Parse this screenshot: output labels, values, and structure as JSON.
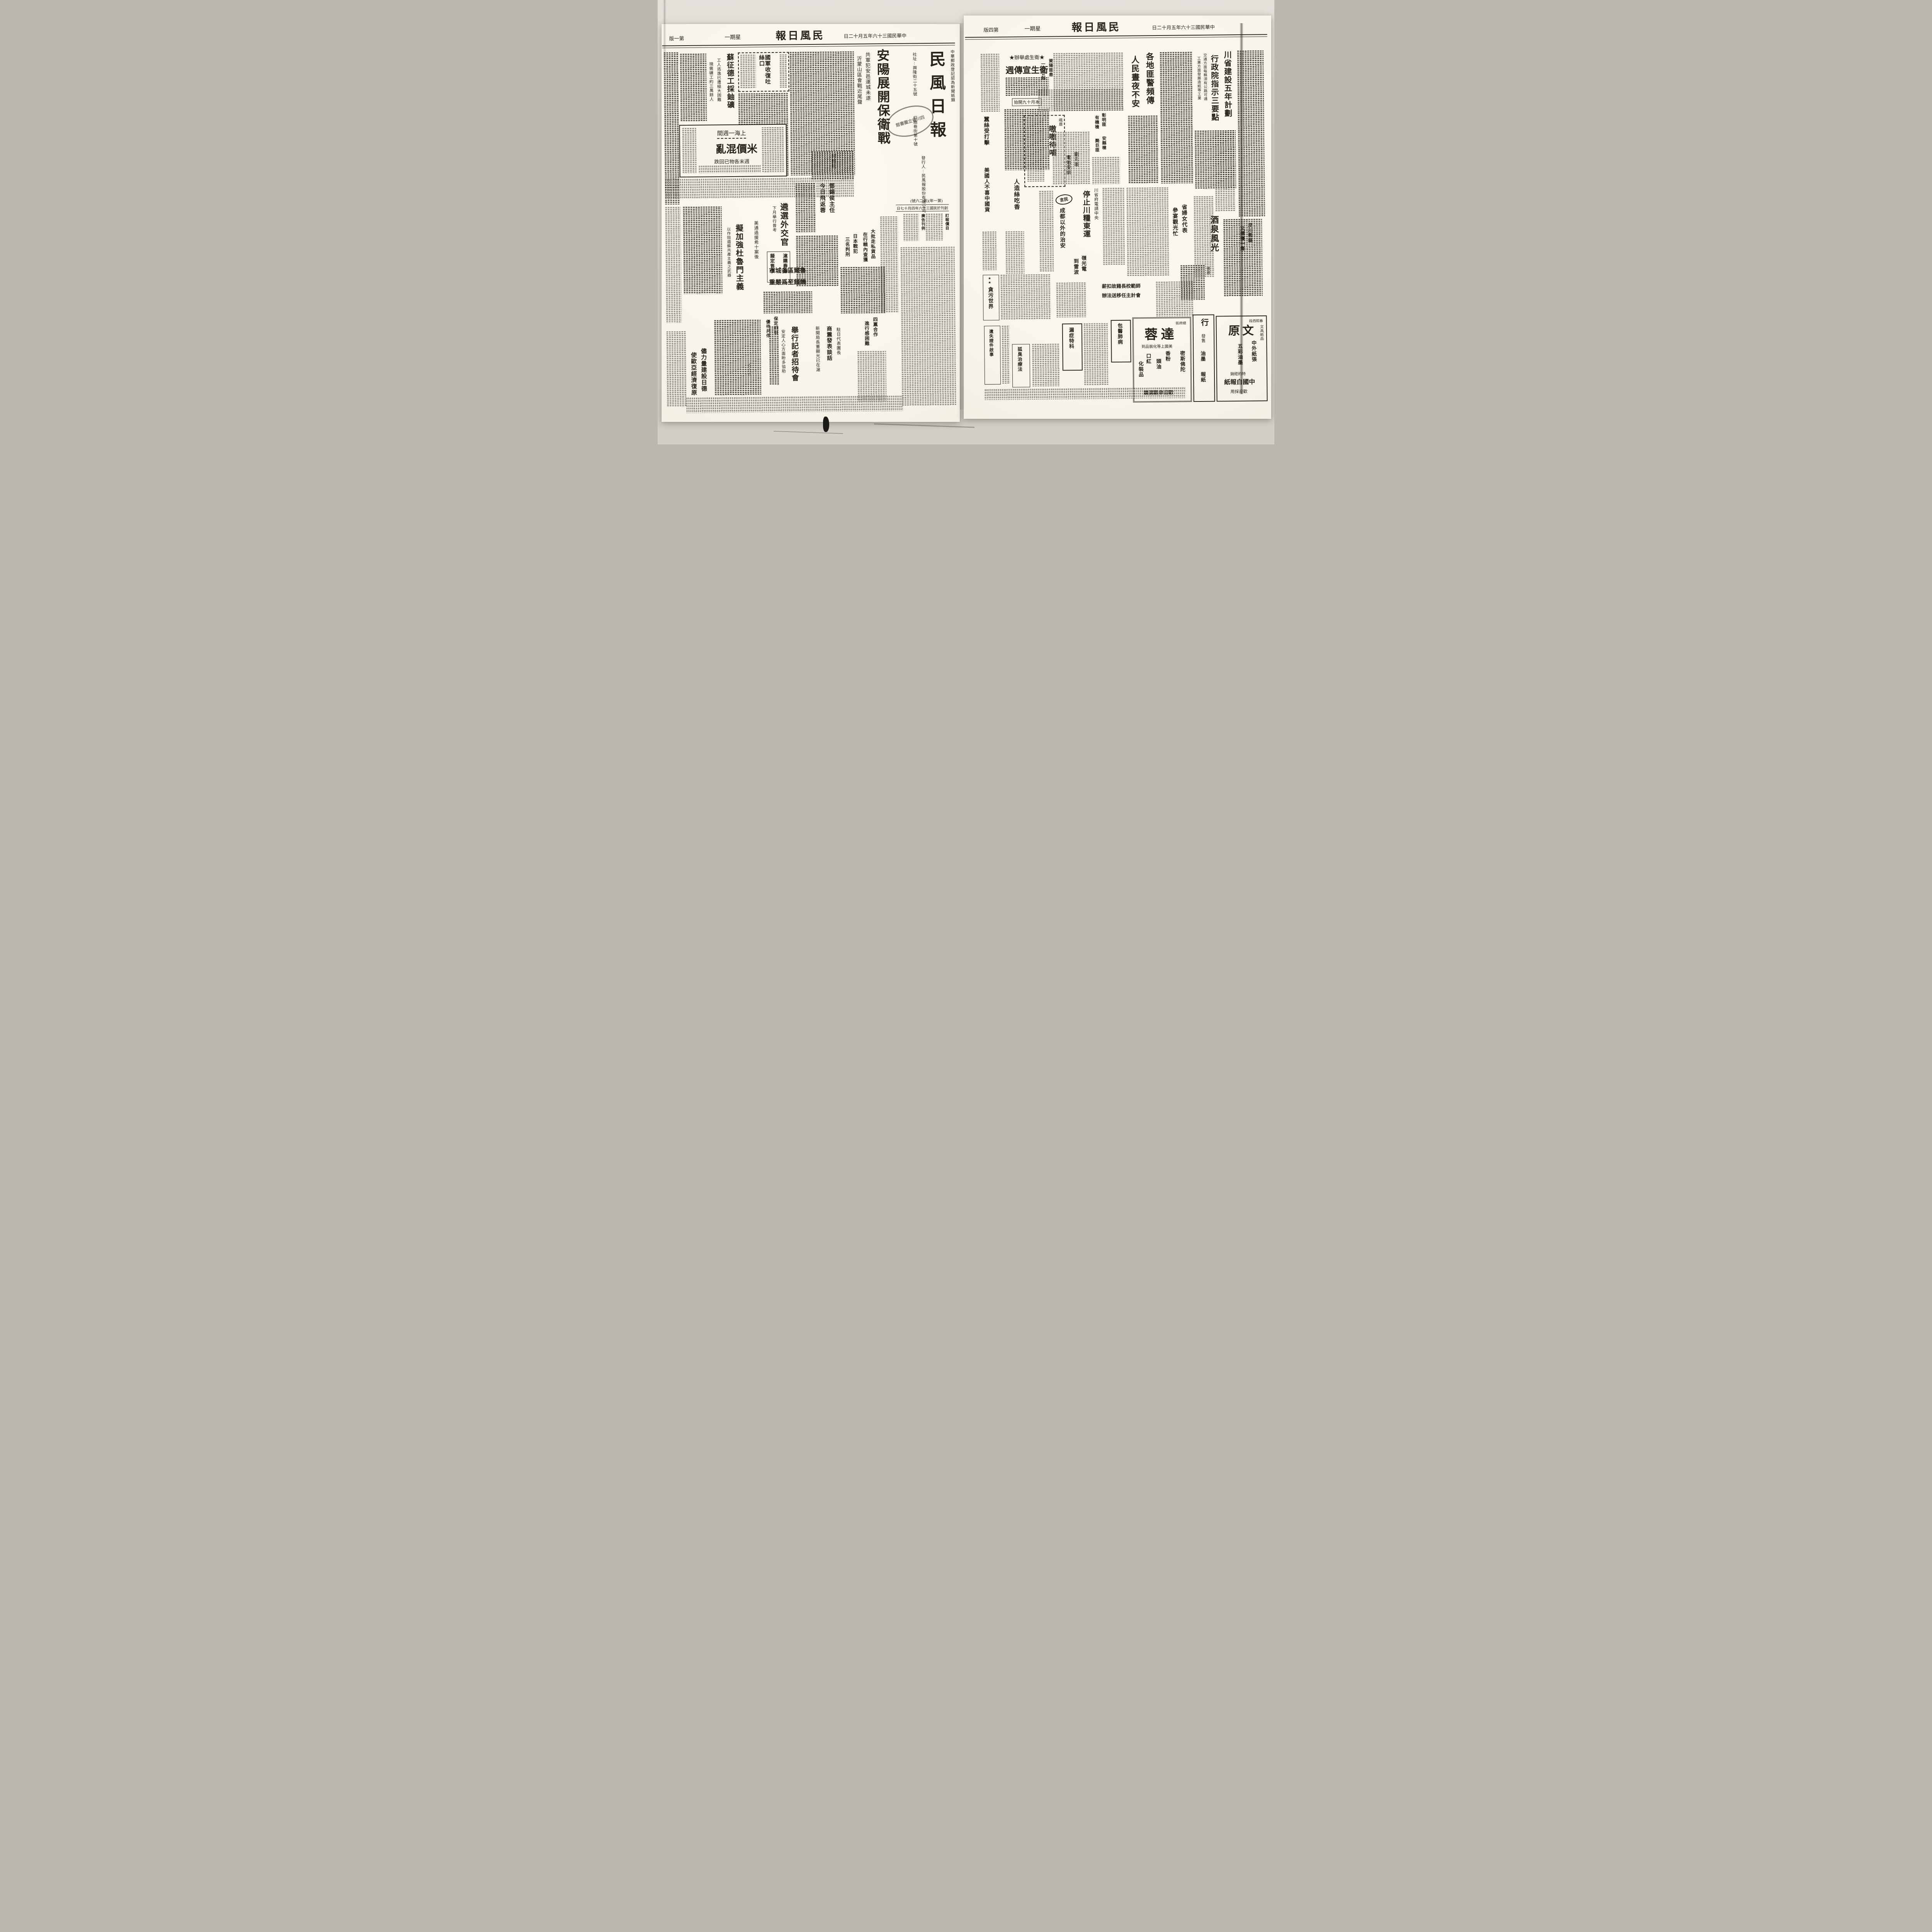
{
  "left_page": {
    "header": {
      "date": "中華民國三十六年五月十二日",
      "weekday": "星期一",
      "title": "民風日報",
      "edition": "第一版"
    },
    "masthead": {
      "title": "民風日報",
      "postal_line": "中華郵政登記認為新聞紙類",
      "publisher_line": "發行人:民風報股份有限公司",
      "address_line": "社址:興隆街二十五號",
      "branch_line": "紅牆巷街第十號",
      "issue_line": "(第一年)(第二六號)",
      "founded_line": "創刊於民國三十六年四月十七日",
      "seal_text": "四川省立圖書館",
      "subscription_title": "訂報價目",
      "adrates_title": "廣告刊例"
    },
    "lead": {
      "kicker": "共軍犯安邑運城未遂",
      "headline": "安陽展開保衛戰",
      "subhead": "沂蒙山區會戰近尾聲"
    },
    "articles": {
      "uranium": {
        "headline": "蘇征德工採鈾礦",
        "sub1": "工人逃逸已遭極大困難",
        "sub2": "現需礦工約三萬餘人"
      },
      "tusikou": {
        "headline": "國軍收復吐絲口"
      },
      "shanghai": {
        "box_title": "上海一週間",
        "headline": "米價混亂",
        "subhead": "週末各物已回跌"
      },
      "heyingqin": {
        "headline": "何應欽"
      },
      "diplomats": {
        "headline": "遴選外交官",
        "subhead": "下月舉行普考"
      },
      "dengxihou": {
        "line1": "鄧錫侯主任",
        "line2": "今日飛返蓉"
      },
      "truman": {
        "kicker": "美通過援希十案後",
        "headline": "擬加強杜魯門主義",
        "subhead": "以作阻遏蘇共產主義之武器"
      },
      "cocoon": {
        "line1": "滬購春繭",
        "line2": "擬定售價"
      },
      "ruhr": {
        "line1": "魯爾區各城市",
        "line2": "饑饉至爲嚴重"
      },
      "warcriminals": {
        "line1": "日本戰犯",
        "line2": "三名判刑"
      },
      "smuggling": {
        "line1": "大批走私貨品",
        "line2": "在行轅內查獲"
      },
      "baoding": {
        "line1": "保定綏署",
        "line2": "優待共俘"
      },
      "fourparty": {
        "line1": "四黨合作",
        "line2": "進行感困難"
      },
      "press": {
        "kicker": "新聞局長董顯光已在滬",
        "headline": "舉行記者招待會",
        "subhead": "安定人心方面盼多協助"
      },
      "shangzhen": {
        "kicker": "駐日代表團長",
        "headline": "商震發表談話"
      },
      "rebuild": {
        "line1": "儘力量建設日德",
        "line2": "使歐亞經濟復原"
      },
      "deco_triangles": "△△△"
    }
  },
  "right_page": {
    "header": {
      "date": "中華民國三十六年五月十二日",
      "weekday": "星期一",
      "title": "民風日報",
      "edition": "第四版"
    },
    "articles": {
      "plan": {
        "headline1": "川省建設五年計劃",
        "headline2": "行政院指示三要點",
        "sub1": "交通方面每縣須有公路可通",
        "sub2": "工業方面發展造紙等工業"
      },
      "hygiene": {
        "kicker": "★衛生處舉辦★",
        "headline": "衛生宣傳週",
        "note": "本月十九開始"
      },
      "banditry": {
        "line1": "各地匪警頻傳",
        "line2": "人民晝夜不安"
      },
      "zhangming": {
        "line1": "彰明匪",
        "line2": "有機槍"
      },
      "anxian": {
        "line1": "安縣槍",
        "line2": "斃巨匪"
      },
      "ziyang": {
        "line1": "資陽匪患",
        "line2": "一月廿起"
      },
      "emei": {
        "kicker": "峨眉",
        "headline": "嗷嗷待哺"
      },
      "rayon": {
        "headline": "人造絲吃香"
      },
      "silk": {
        "headline": "蠶絲受打擊"
      },
      "usgoods": {
        "headline": "美國人不喜中國貨"
      },
      "liuyuanxuan": {
        "line1": "劉元瑄",
        "line2": "電勉受訓"
      },
      "grain": {
        "kicker": "川省府電請中央",
        "headline": "停止川糧東運"
      },
      "lingguang": {
        "line1": "嶺光電",
        "line2": "到雷波"
      },
      "minyan": {
        "logo": "民言",
        "title": "成都以外的治安"
      },
      "women": {
        "line1": "省婦女代表",
        "line2": "參宴觀光忙"
      },
      "jiuquan": {
        "headline": "酒泉風光",
        "byline": "張恩"
      },
      "panda": {
        "line1": "汶川熊貓",
        "line2": "又捕獲一隻"
      },
      "corruption": {
        "stars": "★★",
        "title": "貪污世界"
      },
      "principal": {
        "line1": "師範校長藉故扣薪",
        "line2": "會計主任移送法辦"
      }
    },
    "ads": {
      "lungs": {
        "title": "包醫肺病"
      },
      "gonorrhea": {
        "title": "漏症特科"
      },
      "bodyodor": {
        "title": "狐臭治療法"
      },
      "lost": {
        "title": "遺失證件啟事"
      },
      "darong": {
        "kicker": "總府街",
        "name": "達蓉",
        "tagline": "美國上等化裝品到",
        "items": [
          "密斯佛陀",
          "香粉",
          "頭油",
          "口紅",
          "化裝品"
        ],
        "footer": "歡迎參觀選購"
      },
      "paper_shop": {
        "name": "行",
        "items": [
          "發售",
          "油墨",
          "報紙"
        ]
      },
      "wenyuan": {
        "kicker": "春熙西段",
        "name": "文原",
        "side": "文具紙品",
        "item1": "中外紙張",
        "item2": "五彩油墨",
        "line1": "特約經銷",
        "line2": "中國白報紙",
        "footer": "歡迎採用"
      }
    }
  }
}
